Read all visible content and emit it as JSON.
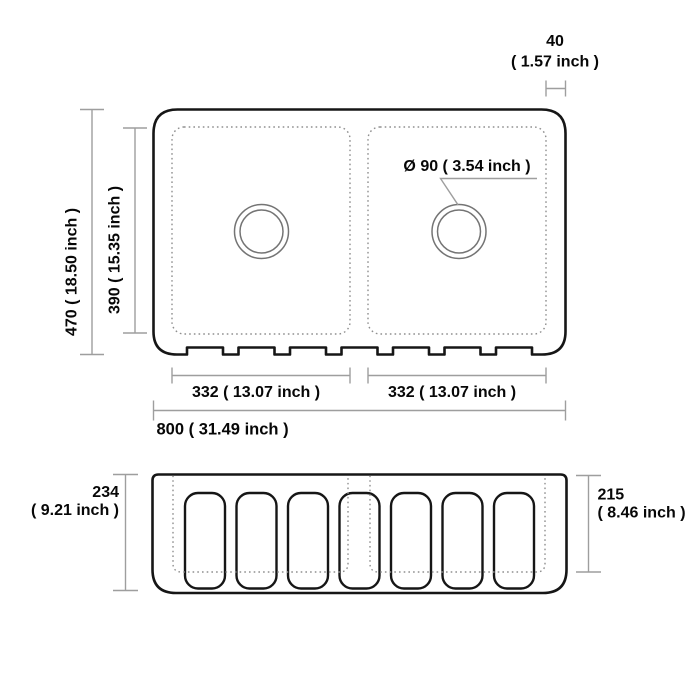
{
  "drawing": {
    "subject": "double-bowl fluted apron kitchen sink dimension drawing",
    "units": "mm ( inch )",
    "colors": {
      "background": "#ffffff",
      "outline": "#161616",
      "dimension_lines": "#9e9e9e",
      "dotted_lines": "#8f8f8f",
      "text": "#070707"
    },
    "top_view": {
      "overall_width_label": "800 ( 31.49 inch )",
      "overall_depth_label": "470 ( 18.50 inch )",
      "bowl_depth_label": "390 ( 15.35 inch )",
      "left_bowl_width_label": "332 ( 13.07 inch )",
      "right_bowl_width_label": "332 ( 13.07 inch )",
      "drain_diameter_label": "Ø 90 ( 3.54 inch )",
      "rim_offset_value": "40",
      "rim_offset_inch": "( 1.57 inch )",
      "bowl_count": 2
    },
    "front_view": {
      "overall_height_value": "234",
      "overall_height_inch": "( 9.21 inch )",
      "inner_height_value": "215",
      "inner_height_inch": "( 8.46 inch )",
      "flute_count": 7
    }
  }
}
